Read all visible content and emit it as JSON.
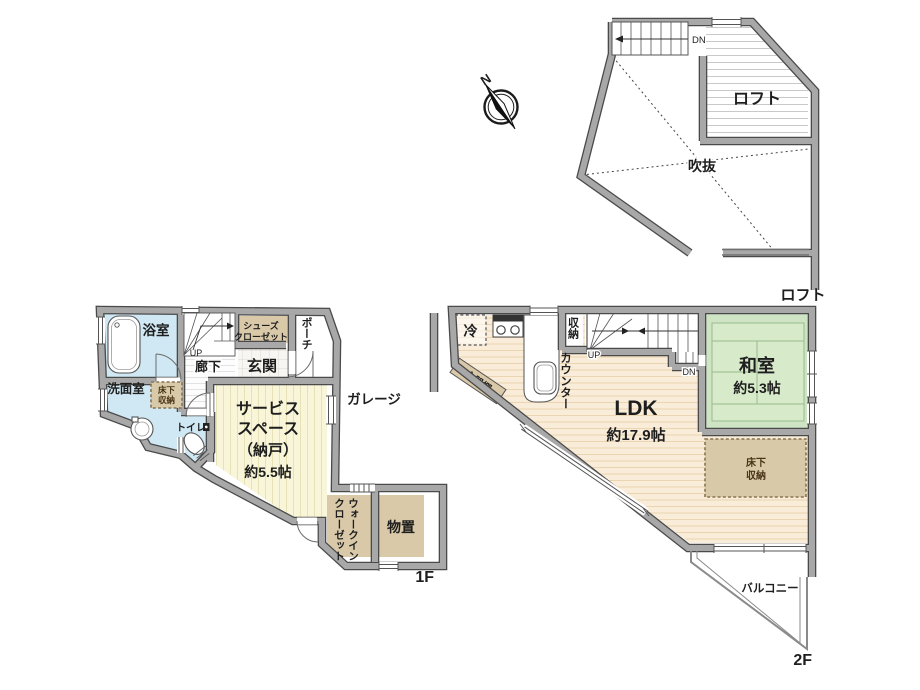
{
  "compass": {
    "north_label": "N"
  },
  "loft_plan": {
    "floor_label": "ロフト",
    "rooms": {
      "loft": "ロフト",
      "void": "吹抜"
    },
    "stairs": {
      "down": "DN"
    }
  },
  "first_floor_plan": {
    "floor_label": "1F",
    "rooms": {
      "bathroom": "浴室",
      "washroom": "洗面室",
      "underfloor_storage_line1": "床下",
      "underfloor_storage_line2": "収納",
      "toilet": "トイレ",
      "corridor": "廊下",
      "entrance": "玄関",
      "shoe_closet_line1": "シューズ",
      "shoe_closet_line2": "クローゼット",
      "porch": "ポーチ",
      "service_space_line1": "サービス",
      "service_space_line2": "スペース",
      "service_space_line3": "（納戸）",
      "service_space_size": "約5.5帖",
      "walk_in_closet_line1": "ウォークイン",
      "walk_in_closet_line2": "クローゼット",
      "storage_room": "物置",
      "garage": "ガレージ"
    },
    "stairs": {
      "up": "UP"
    }
  },
  "second_floor_plan": {
    "floor_label": "2F",
    "rooms": {
      "ldk_name": "LDK",
      "ldk_size": "約17.9帖",
      "japanese_room_name": "和室",
      "japanese_room_size": "約5.3帖",
      "refrigerator": "冷",
      "storage": "収納",
      "counter": "カウンター",
      "cupboard": "食器棚",
      "underfloor_storage_line1": "床下",
      "underfloor_storage_line2": "収納",
      "balcony": "バルコニー"
    },
    "stairs": {
      "up": "UP",
      "down": "DN"
    }
  },
  "palette": {
    "wall_gray": "#a8a8a8",
    "wet_room_blue": "#cfe8f3",
    "service_yellow": "#f8f5d8",
    "wood_floor": "#f9ecd8",
    "tatami_green": "#cfe4c5",
    "tatami_inner": "#d7ebcb",
    "closet_tan": "#d9c9a8",
    "underfloor_tan": "#d8caa8"
  }
}
